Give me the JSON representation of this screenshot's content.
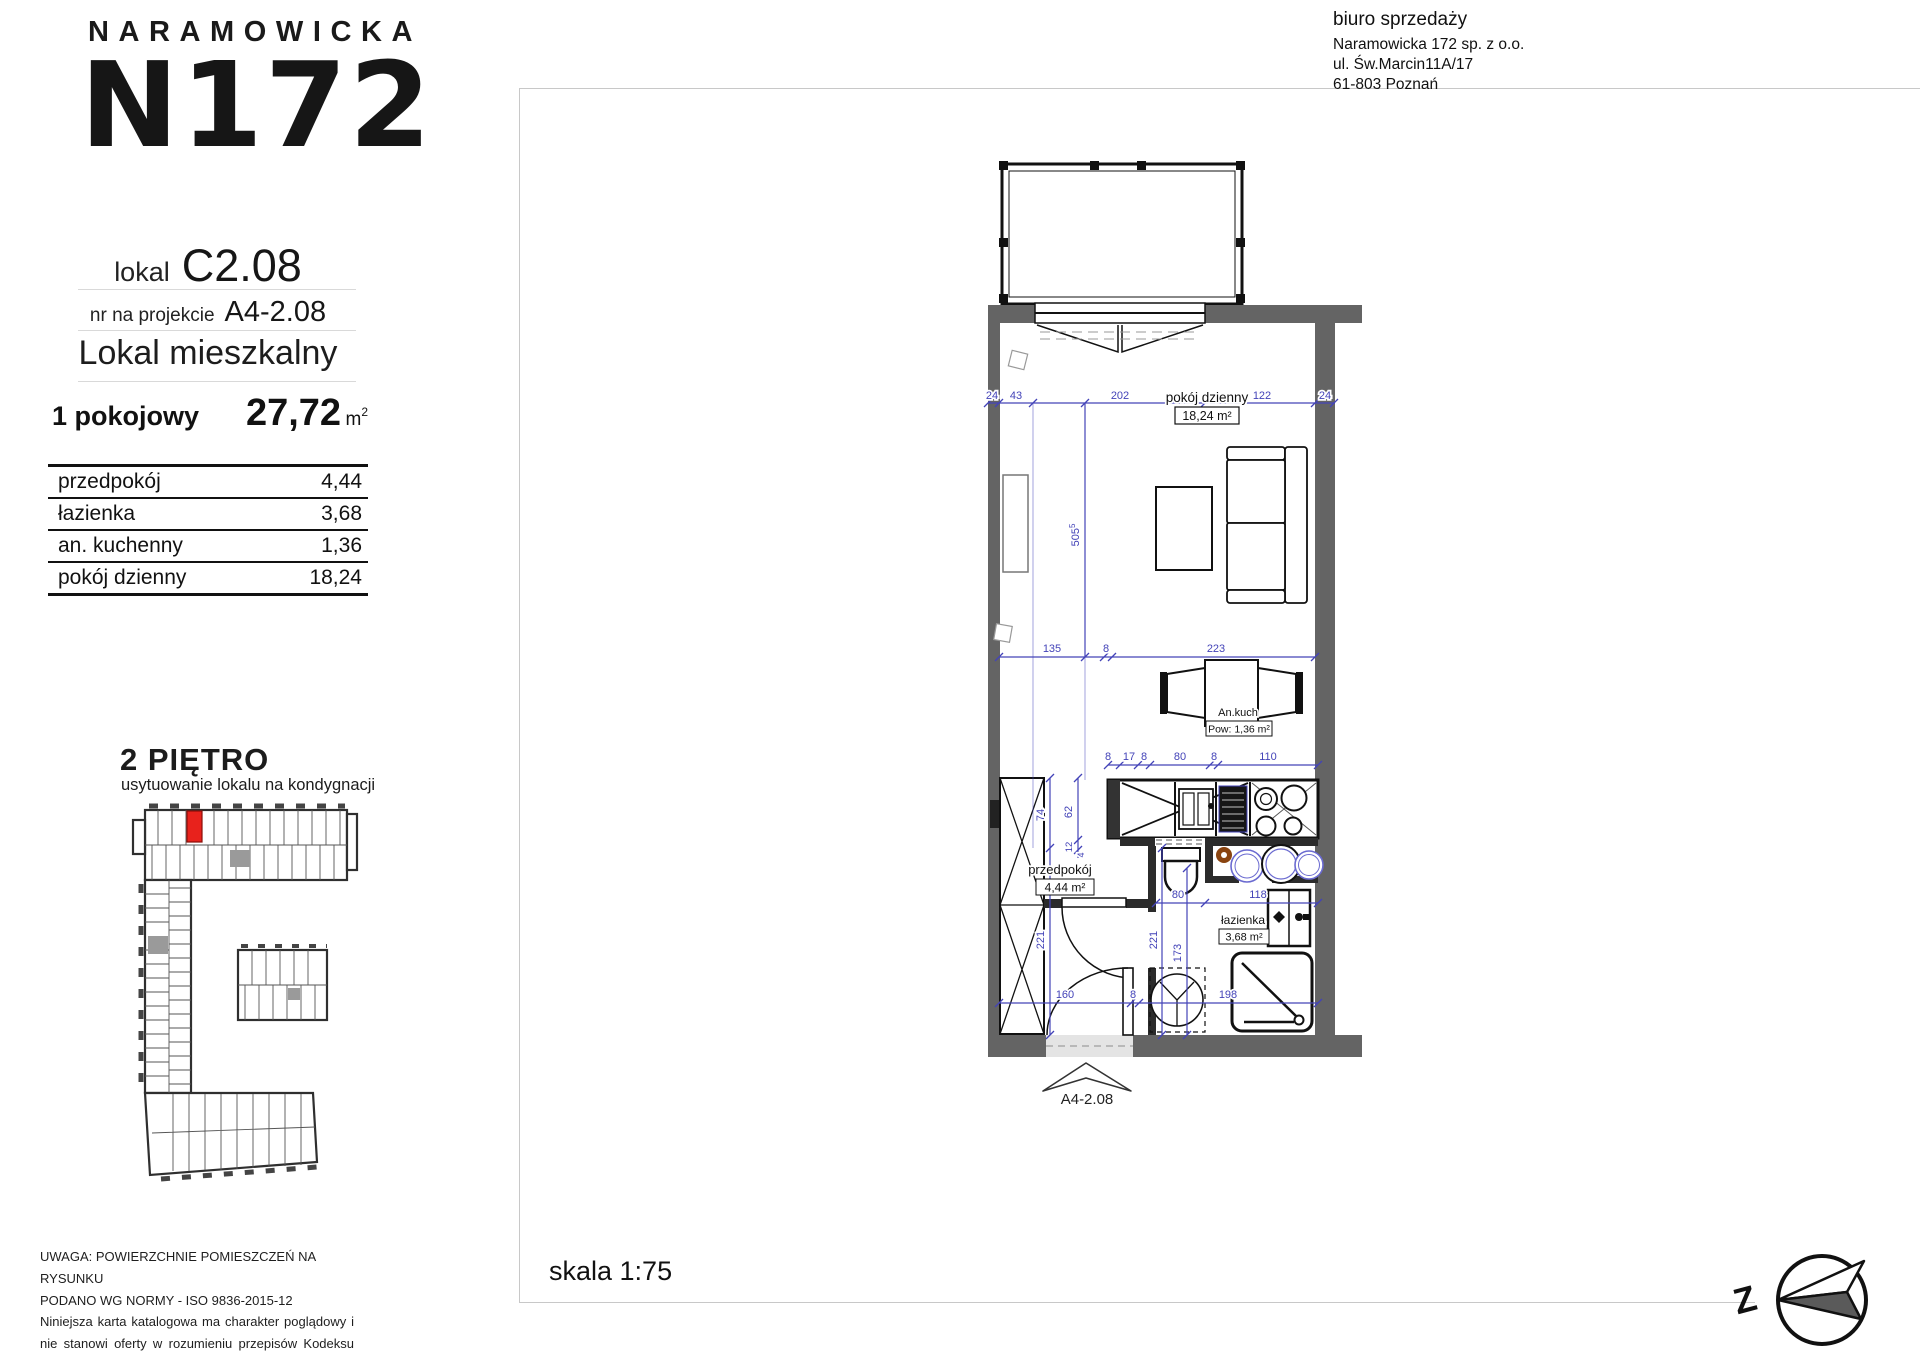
{
  "header": {
    "brand": "NARAMOWICKA",
    "logo": "N172",
    "lokal_label": "lokal",
    "lokal_value": "C2.08",
    "projekt_label": "nr na projekcie",
    "projekt_value": "A4-2.08",
    "type_label": "Lokal mieszkalny"
  },
  "summary": {
    "rooms": "1 pokojowy",
    "area_value": "27,72",
    "unit_base": "m",
    "unit_sup": "2"
  },
  "rooms_table": [
    {
      "name": "przedpokój",
      "area": "4,44"
    },
    {
      "name": "łazienka",
      "area": "3,68"
    },
    {
      "name": "an. kuchenny",
      "area": "1,36"
    },
    {
      "name": "pokój dzienny",
      "area": "18,24"
    }
  ],
  "floor": {
    "title": "2 PIĘTRO",
    "subtitle": "usytuowanie lokalu na kondygnacji"
  },
  "office": {
    "line1": "biuro sprzedaży",
    "line2": "Naramowicka 172 sp. z o.o.",
    "line3": "ul. Św.Marcin11A/17",
    "line4": "61-803 Poznań"
  },
  "scale_label": "skala 1:75",
  "compass_letter": "Z",
  "disclaimer": {
    "line1": "UWAGA: POWIERZCHNIE POMIESZCZEŃ NA RYSUNKU",
    "line2": "PODANO WG NORMY - ISO 9836-2015-12",
    "line3": "Niniejsza karta katalogowa ma charakter poglądowy i nie stanowi oferty w rozumieniu przepisów Kodeksu Cywilnego"
  },
  "plan": {
    "unit_arrow_label": "A4-2.08",
    "labels": {
      "living_name": "pokój dzienny",
      "living_area": "18,24 m²",
      "kitchen_name": "An.kuch",
      "kitchen_area": "Pow: 1,36 m²",
      "hall_name": "przedpokój",
      "hall_area": "4,44 m²",
      "bath_name": "łazienka",
      "bath_area": "3,68 m²"
    },
    "dims": {
      "top": [
        "24",
        "43",
        "202",
        "122",
        "24"
      ],
      "mid": [
        "135",
        "8",
        "223"
      ],
      "kitchen": [
        "8",
        "17",
        "8",
        "80",
        "8",
        "110"
      ],
      "bottom": [
        "160",
        "8",
        "198"
      ],
      "v505": "505",
      "v505_sup": "5",
      "v74": "74",
      "v62": "62",
      "v12": "12",
      "v4": "4",
      "v221a": "221",
      "v221b": "221",
      "v173": "173",
      "h80": "80",
      "h118": "118"
    }
  },
  "colors": {
    "dim_blue": "#4343b8",
    "wall_gray": "#646464",
    "highlight_red": "#e8221c"
  }
}
